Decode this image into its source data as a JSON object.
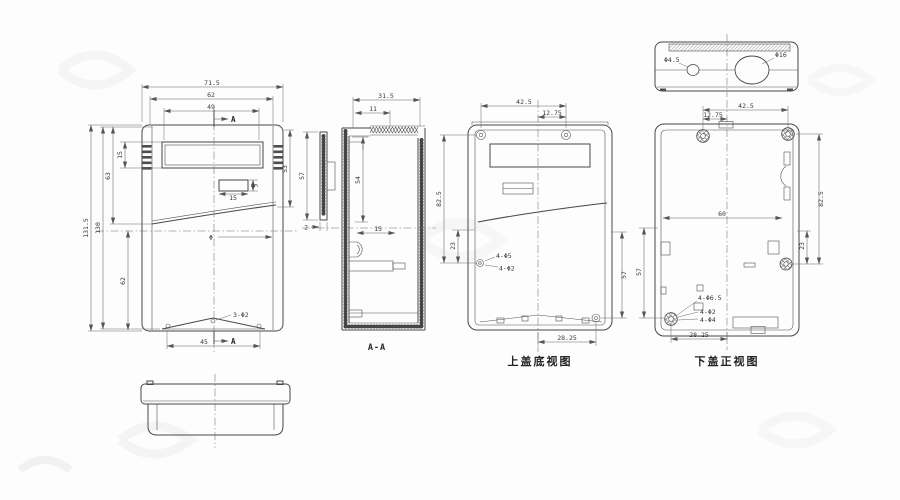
{
  "views": {
    "front": {
      "dim_overall_width": "71.5",
      "dim_inner_width": "62",
      "dim_window_width": "49",
      "dim_overall_height": "131.5",
      "dim_inner_height": "130",
      "dim_upper_height": "63",
      "dim_window_height": "15",
      "dim_lower_height": "62",
      "dim_small_rect_width": "15",
      "dim_small_rect_height": "5",
      "dim_right_height": "53",
      "dim_bottom_width": "45",
      "label_holes": "3-Φ2",
      "label_phi_mark": "Φ",
      "section_arrow": "A"
    },
    "section": {
      "caption": "A-A",
      "dim_width": "31.5",
      "dim_inner_width": "11",
      "dim_inner_height": "54",
      "dim_depth": "15",
      "dim_cover_height": "57",
      "dim_cover_thickness": "2"
    },
    "top_cover": {
      "caption": "上盖底视图",
      "dim_hole_span": "42.5",
      "dim_hole_offset": "12.75",
      "dim_height": "82.5",
      "dim_lower_height": "23",
      "dim_right_height": "57",
      "dim_bottom_span": "28.25",
      "label_holes_large": "4-Φ5",
      "label_holes_small": "4-Φ2"
    },
    "bottom_cover": {
      "caption": "下盖正视图",
      "dim_hole_span": "42.5",
      "dim_hole_offset": "12.75",
      "dim_height": "82.5",
      "dim_lower_height": "23",
      "dim_left_height": "57",
      "dim_inner_width": "60",
      "dim_bottom_span": "28.25",
      "label_boss": "4-Φ6.5",
      "label_hole_mid": "4-Φ2",
      "label_hole_small": "4-Φ4"
    },
    "top_view": {
      "label_small_hole": "Φ4.5",
      "label_large_hole": "Φ16"
    }
  }
}
